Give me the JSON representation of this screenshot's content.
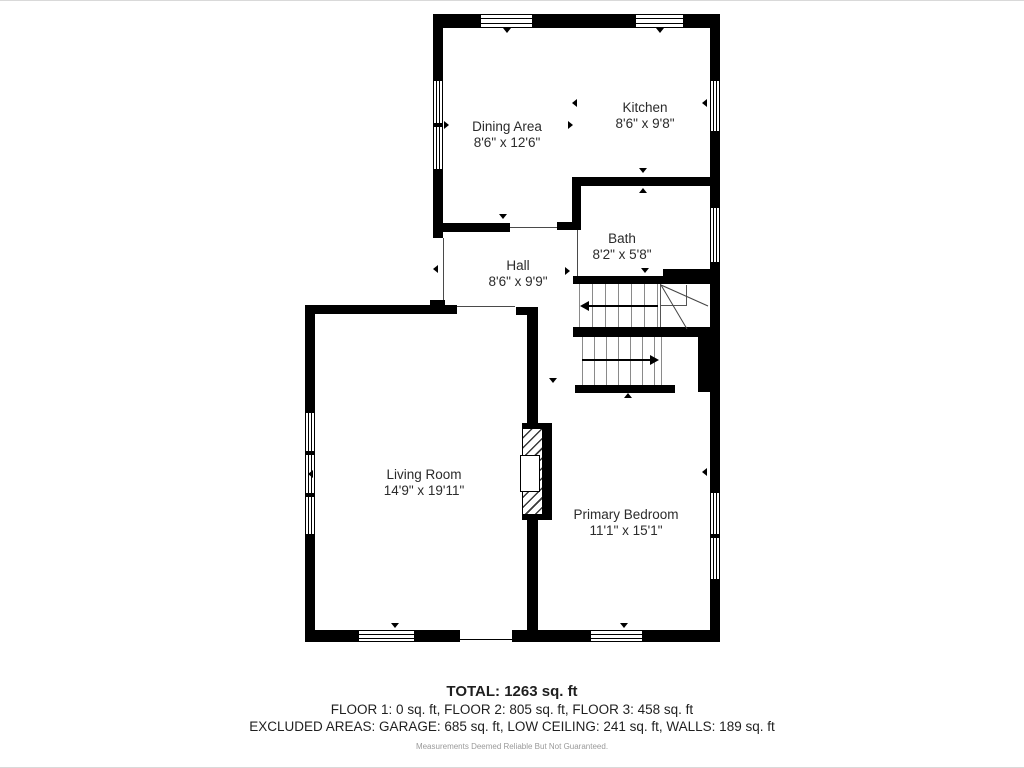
{
  "rooms": {
    "dining": {
      "name": "Dining Area",
      "dims": "8'6\" x 12'6\""
    },
    "kitchen": {
      "name": "Kitchen",
      "dims": "8'6\" x 9'8\""
    },
    "bath": {
      "name": "Bath",
      "dims": "8'2\" x 5'8\""
    },
    "hall": {
      "name": "Hall",
      "dims": "8'6\" x 9'9\""
    },
    "living": {
      "name": "Living Room",
      "dims": "14'9\" x 19'11\""
    },
    "bedroom": {
      "name": "Primary Bedroom",
      "dims": "11'1\" x 15'1\""
    }
  },
  "summary": {
    "total": "TOTAL: 1263 sq. ft",
    "floors": "FLOOR 1: 0 sq. ft, FLOOR 2: 805 sq. ft, FLOOR 3: 458 sq. ft",
    "excluded": "EXCLUDED AREAS: GARAGE: 685 sq. ft, LOW CEILING: 241 sq. ft, WALLS: 189 sq. ft",
    "disclaimer": "Measurements Deemed Reliable But Not Guaranteed."
  },
  "colors": {
    "wall": "#000000",
    "background": "#ffffff",
    "stair_tread": "#8a8a8a",
    "text": "#2b2b2b",
    "disclaimer_text": "#9a9a9a"
  }
}
